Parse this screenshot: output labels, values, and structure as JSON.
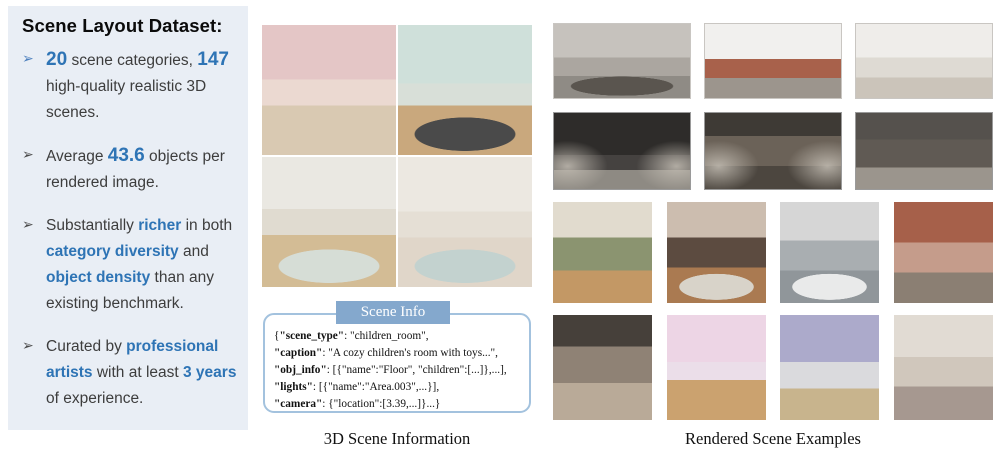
{
  "colors": {
    "accent_blue": "#2E74B5",
    "panel_bg": "#E9EEF5",
    "body_text": "#3D3D3D",
    "tab_bg": "#84A8CD",
    "box_border": "#A3C2DE"
  },
  "left_panel": {
    "title": "Scene Layout Dataset:",
    "bullet_marker": "➢",
    "bullets": [
      {
        "arrow_accent": true,
        "segments": [
          {
            "text": "20",
            "accent": true,
            "big": true
          },
          {
            "text": " scene categories, "
          },
          {
            "text": "147",
            "accent": true,
            "big": true
          },
          {
            "text": " high-quality realistic 3D scenes."
          }
        ]
      },
      {
        "arrow_accent": false,
        "segments": [
          {
            "text": "Average "
          },
          {
            "text": "43.6",
            "accent": true,
            "big": true
          },
          {
            "text": " objects per rendered image."
          }
        ]
      },
      {
        "arrow_accent": false,
        "segments": [
          {
            "text": "Substantially "
          },
          {
            "text": "richer",
            "accent": true
          },
          {
            "text": " in both "
          },
          {
            "text": "category diversity",
            "accent": true
          },
          {
            "text": " and "
          },
          {
            "text": "object density",
            "accent": true
          },
          {
            "text": " than any existing benchmark."
          }
        ]
      },
      {
        "arrow_accent": false,
        "segments": [
          {
            "text": "Curated by "
          },
          {
            "text": "professional artists",
            "accent": true
          },
          {
            "text": " with at least "
          },
          {
            "text": "3 years",
            "accent": true
          },
          {
            "text": " of experience."
          }
        ]
      }
    ]
  },
  "scene_info": {
    "tab_label": "Scene Info",
    "lines": [
      [
        {
          "text": "{"
        },
        {
          "text": "\"scene_type\"",
          "bold": true
        },
        {
          "text": ": \"children_room\","
        }
      ],
      [
        {
          "text": "\"caption\"",
          "bold": true
        },
        {
          "text": ": \"A cozy children's room with toys...\","
        }
      ],
      [
        {
          "text": "\"obj_info\"",
          "bold": true
        },
        {
          "text": ":  [{\"name\":\"Floor\", \"children\":[...]},...],"
        }
      ],
      [
        {
          "text": "\"lights\"",
          "bold": true
        },
        {
          "text": ": [{\"name\":\"Area.003\",...}],"
        }
      ],
      [
        {
          "text": "\"camera\"",
          "bold": true
        },
        {
          "text": ": {\"location\":[3.39,...]}...}"
        }
      ]
    ]
  },
  "captions": {
    "middle": "3D Scene Information",
    "right": "Rendered Scene Examples"
  },
  "middle_grid": {
    "images": [
      {
        "name": "thumb-childrens-room-pink-bunkbed",
        "label": "pink children's room with white bunk bed",
        "bands": [
          [
            "#E4C6C6",
            "0%",
            "42%"
          ],
          [
            "#EBD9D1",
            "42%",
            "62%"
          ],
          [
            "#D9C9B2",
            "62%",
            "100%"
          ]
        ]
      },
      {
        "name": "thumb-childrens-room-blue-bunkbed",
        "label": "mint children's room with blue bunk bed and deer figure",
        "bands": [
          [
            "#CFE0DA",
            "0%",
            "45%"
          ],
          [
            "#D8DFD8",
            "45%",
            "62%"
          ],
          [
            "#C9A87D",
            "62%",
            "100%"
          ]
        ],
        "rug": "#4A4A4A"
      },
      {
        "name": "thumb-clinic-room",
        "label": "clinic room with olive cabinets and dental chair",
        "bands": [
          [
            "#EAE8E2",
            "0%",
            "40%"
          ],
          [
            "#E0DBD0",
            "40%",
            "60%"
          ],
          [
            "#D3BC95",
            "60%",
            "100%"
          ]
        ],
        "rug": "#D6DDD6"
      },
      {
        "name": "thumb-dining-room",
        "label": "dining room with round table and wooden blinds",
        "bands": [
          [
            "#ECE8E1",
            "0%",
            "42%"
          ],
          [
            "#E5DFD5",
            "42%",
            "62%"
          ],
          [
            "#E0D6C9",
            "62%",
            "100%"
          ]
        ],
        "rug": "#C3D2CF"
      }
    ]
  },
  "right_grid": {
    "rows": [
      {
        "top": 23,
        "height": 76,
        "item_width": 138,
        "frame": "#C9C6C2",
        "images": [
          {
            "name": "thumb-gray-bedroom-tv",
            "label": "gray bedroom with TV and twin beds",
            "bands": [
              [
                "#C6C2BD",
                "0%",
                "45%"
              ],
              [
                "#ABA6A0",
                "45%",
                "70%"
              ],
              [
                "#8F8B85",
                "70%",
                "100%"
              ]
            ],
            "rug": "#5A554F"
          },
          {
            "name": "thumb-brick-construction-site",
            "label": "brick wall with construction materials on concrete",
            "bands": [
              [
                "#F1F0EE",
                "0%",
                "47%"
              ],
              [
                "#A8614B",
                "47%",
                "73%"
              ],
              [
                "#9C958D",
                "73%",
                "100%"
              ]
            ]
          },
          {
            "name": "thumb-white-bedroom-chandelier",
            "label": "white bedroom with chandelier and posters",
            "bands": [
              [
                "#EFEDEA",
                "0%",
                "45%"
              ],
              [
                "#DEDAD3",
                "45%",
                "72%"
              ],
              [
                "#CBC4BA",
                "72%",
                "100%"
              ]
            ]
          }
        ]
      },
      {
        "top": 112,
        "height": 78,
        "item_width": 138,
        "frame": "#9A9A9A",
        "images": [
          {
            "name": "thumb-dark-stage-living-room",
            "label": "dark spotlit stage with leather couch and shelves",
            "bands": [
              [
                "#2E2C2A",
                "0%",
                "55%"
              ],
              [
                "#454240",
                "55%",
                "75%"
              ],
              [
                "#8E8A83",
                "75%",
                "100%"
              ]
            ],
            "dark": true
          },
          {
            "name": "thumb-dark-vintage-living-room",
            "label": "dark vintage living room with curtains and chandelier",
            "bands": [
              [
                "#3E3A35",
                "0%",
                "30%"
              ],
              [
                "#6B6258",
                "30%",
                "70%"
              ],
              [
                "#4C463F",
                "70%",
                "100%"
              ]
            ],
            "dark": true
          },
          {
            "name": "thumb-dark-warehouse-stage",
            "label": "dark warehouse stage with tarps and sofa",
            "bands": [
              [
                "#55514D",
                "0%",
                "35%"
              ],
              [
                "#605A54",
                "35%",
                "72%"
              ],
              [
                "#9B958D",
                "72%",
                "100%"
              ]
            ]
          }
        ]
      },
      {
        "top": 202,
        "height": 101,
        "item_width": 99,
        "frame": null,
        "images": [
          {
            "name": "thumb-plant-room",
            "label": "room crowded with potted plants and shelves",
            "bands": [
              [
                "#E1DBCE",
                "0%",
                "35%"
              ],
              [
                "#8B9470",
                "35%",
                "68%"
              ],
              [
                "#C39865",
                "68%",
                "100%"
              ]
            ]
          },
          {
            "name": "thumb-meeting-room",
            "label": "meeting room with long table and purple chairs",
            "bands": [
              [
                "#CCBDAF",
                "0%",
                "35%"
              ],
              [
                "#5C4B40",
                "35%",
                "65%"
              ],
              [
                "#AA7A51",
                "65%",
                "100%"
              ]
            ],
            "rug": "#D8D3C9"
          },
          {
            "name": "thumb-bathroom",
            "label": "bathroom with freestanding bathtub and gray tile",
            "bands": [
              [
                "#D6D6D6",
                "0%",
                "38%"
              ],
              [
                "#A9AEB1",
                "38%",
                "68%"
              ],
              [
                "#90969A",
                "68%",
                "100%"
              ]
            ],
            "rug": "#E9EAEA"
          },
          {
            "name": "thumb-brick-workshop",
            "label": "brick-walled workshop with desk and tools",
            "bands": [
              [
                "#A6604A",
                "0%",
                "40%"
              ],
              [
                "#C59C8B",
                "40%",
                "70%"
              ],
              [
                "#8B7F73",
                "70%",
                "100%"
              ]
            ]
          }
        ]
      },
      {
        "top": 315,
        "height": 105,
        "item_width": 99,
        "frame": null,
        "images": [
          {
            "name": "thumb-cluttered-garage",
            "label": "cluttered garage storage room",
            "bands": [
              [
                "#46403A",
                "0%",
                "30%"
              ],
              [
                "#8F8275",
                "30%",
                "65%"
              ],
              [
                "#B9AA98",
                "65%",
                "100%"
              ]
            ]
          },
          {
            "name": "thumb-pink-kids-room",
            "label": "pink children's room with bunk bed and cat poster",
            "bands": [
              [
                "#EDD5E5",
                "0%",
                "45%"
              ],
              [
                "#EBDEE9",
                "45%",
                "62%"
              ],
              [
                "#CBA26F",
                "62%",
                "100%"
              ]
            ]
          },
          {
            "name": "thumb-lavender-bedroom",
            "label": "lavender bedroom with white bed and guitar",
            "bands": [
              [
                "#ACAACB",
                "0%",
                "45%"
              ],
              [
                "#DADADD",
                "45%",
                "70%"
              ],
              [
                "#C8B48D",
                "70%",
                "100%"
              ]
            ]
          },
          {
            "name": "thumb-music-room",
            "label": "music room with guitars on wall and desk speakers",
            "bands": [
              [
                "#E1DBD3",
                "0%",
                "40%"
              ],
              [
                "#D0C7BC",
                "40%",
                "68%"
              ],
              [
                "#A69890",
                "68%",
                "100%"
              ]
            ]
          }
        ]
      }
    ]
  }
}
